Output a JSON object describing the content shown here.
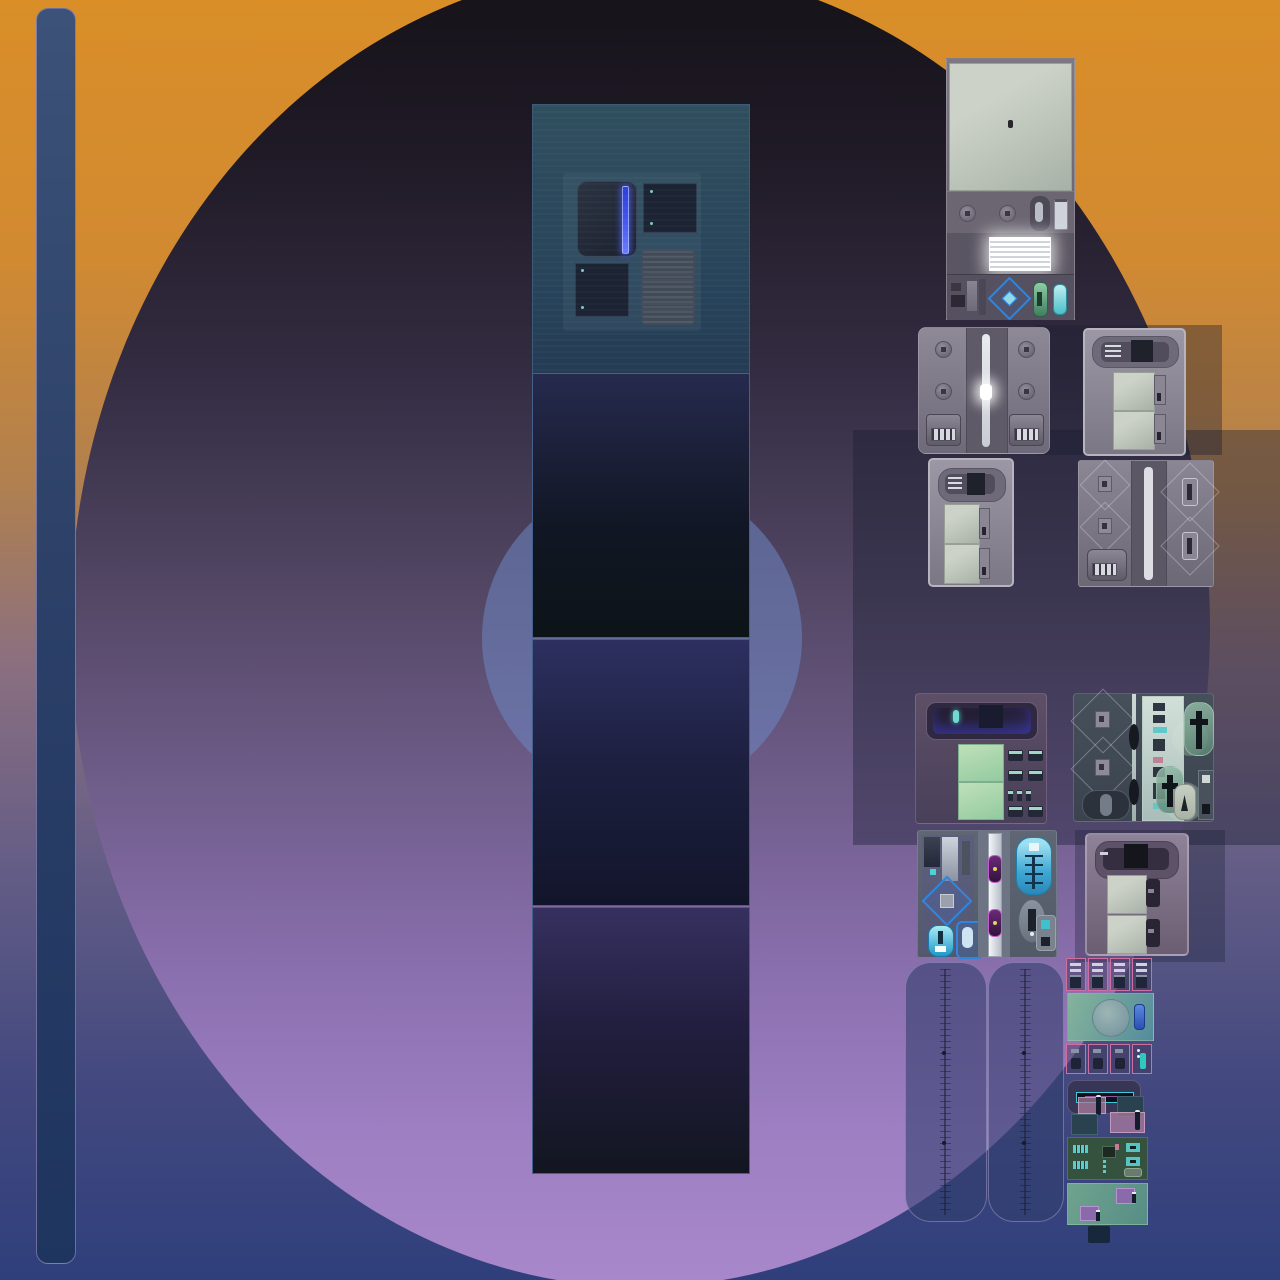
{
  "scene": {
    "kind": "game-texture-atlas",
    "description": "Top-down machine and appliance sprite tiles composed over a gradient backdrop with a large circle, a left vertical bar sprite and a stacked panel column; no text labels visible",
    "text_content": ""
  },
  "palette": {
    "bgTop": "#d98e28",
    "bgMid": "#8a6f80",
    "bgBottom": "#2f3f7c",
    "circleTop": "#151218",
    "circleBottom": "#a888ca",
    "innerCircle": "#6e87c3",
    "barTop": "#3c5278",
    "barBottom": "#1e3560",
    "accentBlue": "#2f86e0",
    "glowStrip": "#4455ee",
    "mint": "#bfe0b8",
    "sage": "#ccd2c8",
    "cyan": "#49c0c8",
    "magenta": "#c85ad0",
    "pinkOutline": "#cf6f9f",
    "tealOutline": "#3fc8d8",
    "boardGreen": "#35523e",
    "chipPurple": "#8a6aaa",
    "slabBlue": "#4d577a"
  },
  "sprites": [
    {
      "name": "vertical-bar"
    },
    {
      "name": "panel-column-teal-with-device-group"
    },
    {
      "name": "panel-navy"
    },
    {
      "name": "panel-indigo"
    },
    {
      "name": "panel-violet"
    },
    {
      "name": "tall-machine-with-plate-vent-and-diamond"
    },
    {
      "name": "bolted-machine-with-center-light-track"
    },
    {
      "name": "slot-machine-small"
    },
    {
      "name": "slot-machine-vertical"
    },
    {
      "name": "diamond-column-machine"
    },
    {
      "name": "purple-machine-with-mint-panels-and-switches"
    },
    {
      "name": "teal-machine-with-cross-capsules"
    },
    {
      "name": "blue-highlight-machine-with-magenta-knobs"
    },
    {
      "name": "purple-slot-machine"
    },
    {
      "name": "tall-slab-left"
    },
    {
      "name": "tall-slab-right"
    },
    {
      "name": "pink-outlined-switch-row"
    },
    {
      "name": "green-panel-with-circle"
    },
    {
      "name": "pink-outlined-knob-row"
    },
    {
      "name": "teal-slot-capsule"
    },
    {
      "name": "pin-connectors"
    },
    {
      "name": "circuit-board"
    },
    {
      "name": "chip-panel"
    }
  ]
}
